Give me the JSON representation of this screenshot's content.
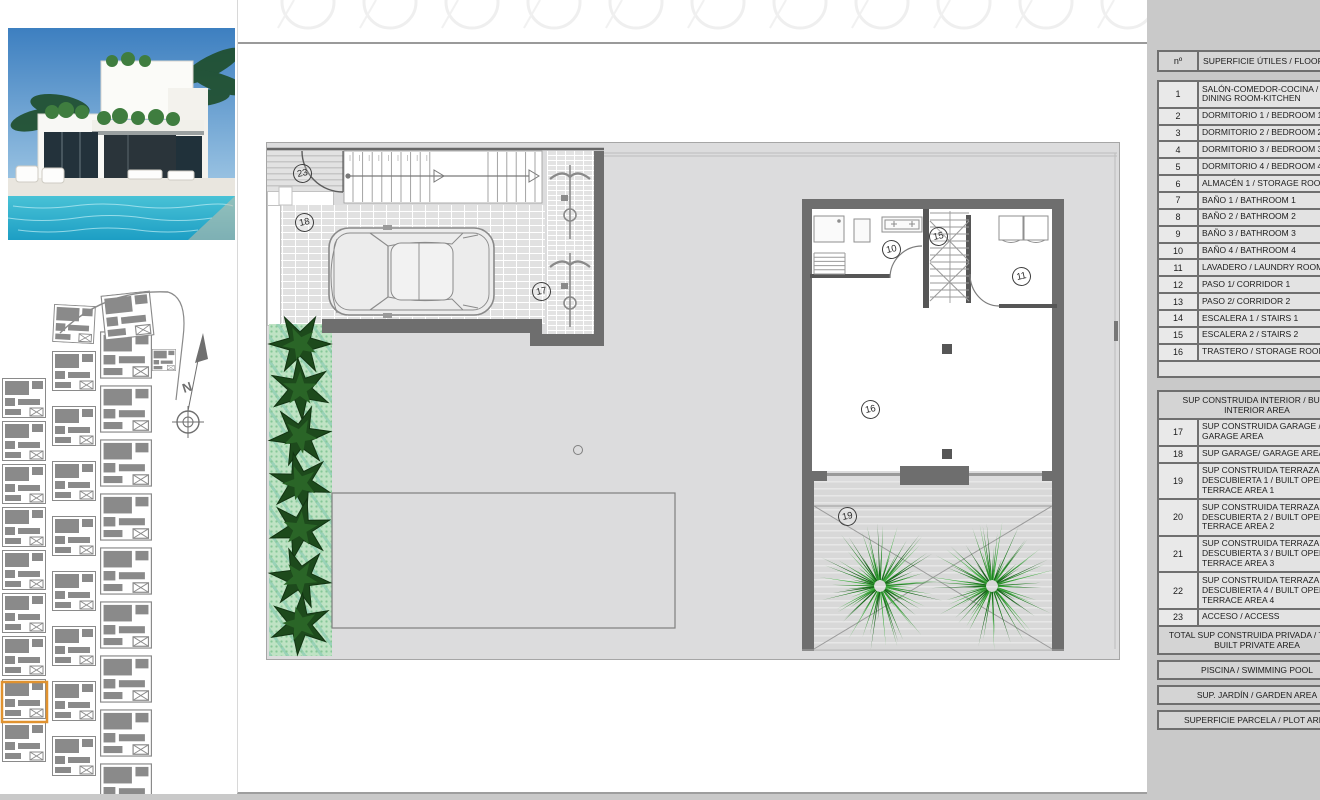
{
  "plan": {
    "labels": {
      "access": "23",
      "garage": "18",
      "carport": "17",
      "bathroom": "10",
      "stairs2": "15",
      "laundry": "11",
      "storage": "16",
      "terrace": "19"
    },
    "compass_north": "N"
  },
  "area_table": {
    "header_no": "nº",
    "header_label": "SUPERFICIE ÚTILES / FLOOR AREA",
    "rows": [
      {
        "num": "1",
        "label": "SALÓN-COMEDOR-COCINA / LIVING-DINING ROOM-KITCHEN"
      },
      {
        "num": "2",
        "label": "DORMITORIO 1 / BEDROOM 1"
      },
      {
        "num": "3",
        "label": "DORMITORIO 2 / BEDROOM 2"
      },
      {
        "num": "4",
        "label": "DORMITORIO 3 / BEDROOM 3"
      },
      {
        "num": "5",
        "label": "DORMITORIO 4 / BEDROOM 4"
      },
      {
        "num": "6",
        "label": "ALMACÉN 1 / STORAGE ROOM"
      },
      {
        "num": "7",
        "label": "BAÑO 1 / BATHROOM 1"
      },
      {
        "num": "8",
        "label": "BAÑO 2 / BATHROOM 2"
      },
      {
        "num": "9",
        "label": "BAÑO 3 / BATHROOM 3"
      },
      {
        "num": "10",
        "label": "BAÑO 4 / BATHROOM 4"
      },
      {
        "num": "11",
        "label": "LAVADERO / LAUNDRY ROOM"
      },
      {
        "num": "12",
        "label": "PASO 1/ CORRIDOR 1"
      },
      {
        "num": "13",
        "label": "PASO 2/ CORRIDOR 2"
      },
      {
        "num": "14",
        "label": "ESCALERA 1 / STAIRS 1"
      },
      {
        "num": "15",
        "label": "ESCALERA 2 / STAIRS 2"
      },
      {
        "num": "16",
        "label": "TRASTERO / STORAGE ROOM"
      }
    ],
    "interior_band": "SUP CONSTRUIDA INTERIOR / BUILT INTERIOR AREA",
    "rows2": [
      {
        "num": "17",
        "label": "SUP CONSTRUIDA GARAGE / BUILT GARAGE AREA"
      },
      {
        "num": "18",
        "label": "SUP GARAGE/ GARAGE AREA"
      },
      {
        "num": "19",
        "label": "SUP CONSTRUIDA TERRAZA DESCUBIERTA 1 / BUILT OPEN TERRACE AREA 1"
      },
      {
        "num": "20",
        "label": "SUP CONSTRUIDA TERRAZA DESCUBIERTA 2 / BUILT OPEN TERRACE AREA 2"
      },
      {
        "num": "21",
        "label": "SUP CONSTRUIDA TERRAZA DESCUBIERTA 3 / BUILT OPEN TERRACE AREA 3"
      },
      {
        "num": "22",
        "label": "SUP CONSTRUIDA TERRAZA DESCUBIERTA 4 / BUILT OPEN TERRACE AREA 4"
      },
      {
        "num": "23",
        "label": "ACCESO / ACCESS"
      }
    ],
    "total_band": "TOTAL SUP CONSTRUIDA PRIVADA / TOTAL BUILT PRIVATE AREA",
    "pool_band": "PISCINA / SWIMMING POOL",
    "garden_band": "SUP. JARDÍN / GARDEN AREA",
    "plot_band": "SUPERFICIE PARCELA / PLOT AREA"
  },
  "colors": {
    "accent_orange": "#e0922f",
    "wall_gray": "#6e6e6e",
    "palm_green": "#2c8f2c",
    "garden_bed_green": "#bfe3c4",
    "panel_gray": "#c9c9c9",
    "plan_gray": "#dcdcdd"
  }
}
